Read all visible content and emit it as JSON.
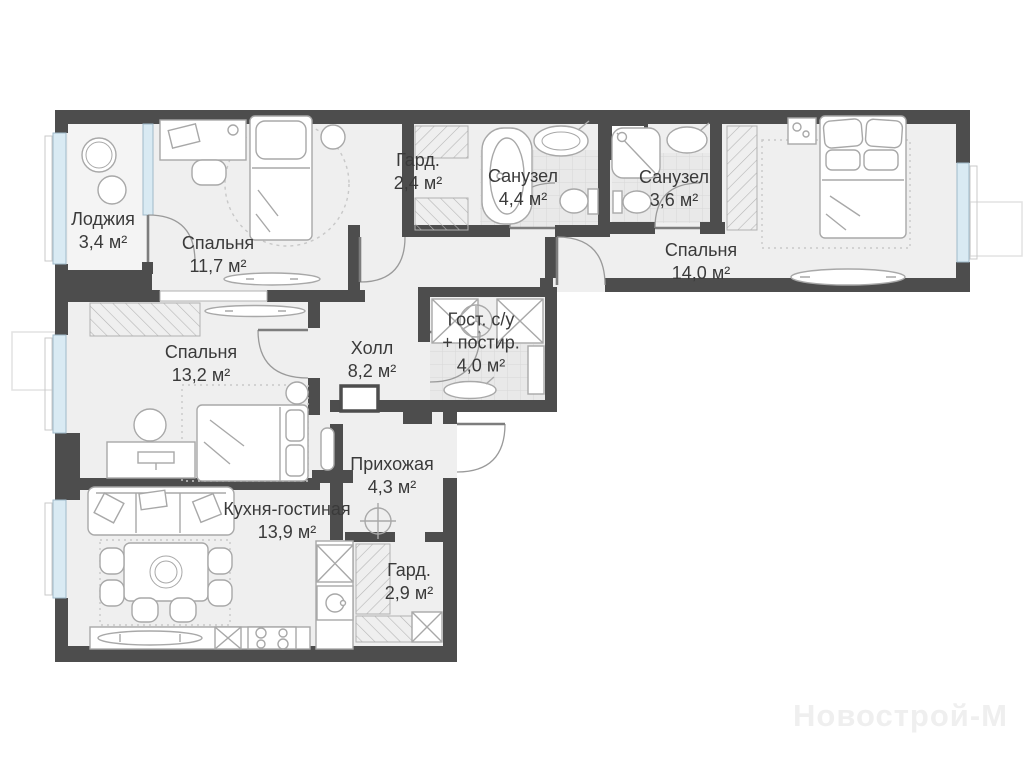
{
  "plan": {
    "watermark": "Новострой-М",
    "rooms": [
      {
        "id": "loggia",
        "name": "Лоджия",
        "area": "3,4 м²"
      },
      {
        "id": "bedroom1",
        "name": "Спальня",
        "area": "11,7 м²"
      },
      {
        "id": "wardrobe1",
        "name": "Гард.",
        "area": "2,4 м²"
      },
      {
        "id": "bath1",
        "name": "Санузел",
        "area": "4,4 м²"
      },
      {
        "id": "bath2",
        "name": "Санузел",
        "area": "3,6 м²"
      },
      {
        "id": "bedroom2",
        "name": "Спальня",
        "area": "14,0 м²"
      },
      {
        "id": "bedroom3",
        "name": "Спальня",
        "area": "13,2 м²"
      },
      {
        "id": "hall",
        "name": "Холл",
        "area": "8,2 м²"
      },
      {
        "id": "guest_wc",
        "name": "Гост. с/у",
        "name2": "+ постир.",
        "area": "4,0 м²"
      },
      {
        "id": "entry",
        "name": "Прихожая",
        "area": "4,3 м²"
      },
      {
        "id": "kitchen",
        "name": "Кухня-гостиная",
        "area": "13,9 м²"
      },
      {
        "id": "wardrobe2",
        "name": "Гард.",
        "area": "2,9 м²"
      }
    ],
    "colors": {
      "wall": "#4d4d4d",
      "floor": "#efefef",
      "window": "#d9eaf3",
      "furniture_line": "#a8a8a8"
    }
  }
}
